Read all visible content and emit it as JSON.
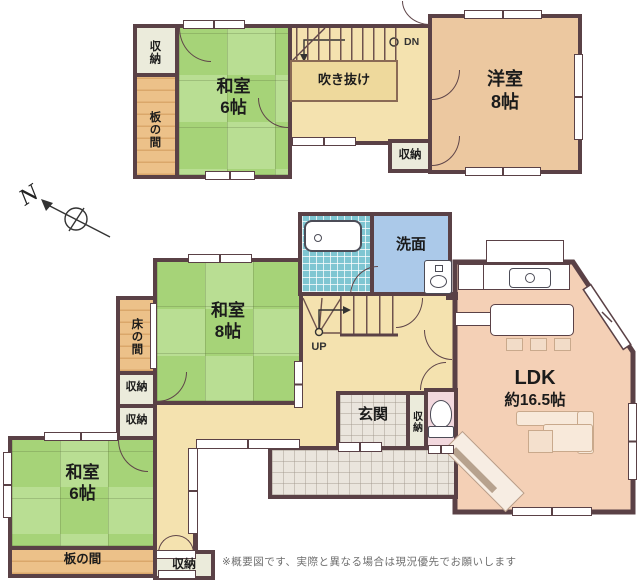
{
  "meta": {
    "footer_note": "※概要図です、実際と異なる場合は現況優先でお願いします"
  },
  "compass": {
    "label": "N"
  },
  "floor2": {
    "closet_top": {
      "label": "収納"
    },
    "itanoma": {
      "label": "板の間"
    },
    "washitsu6": {
      "name": "和室",
      "size": "6帖"
    },
    "stairs": {
      "dn": "DN"
    },
    "void": {
      "label": "吹き抜け"
    },
    "closet_mid": {
      "label": "収納"
    },
    "youshitsu8": {
      "name": "洋室",
      "size": "8帖"
    }
  },
  "floor1": {
    "washitsu8": {
      "name": "和室",
      "size": "8帖"
    },
    "tokonoma": {
      "label": "床の間"
    },
    "closet_a": {
      "label": "収納"
    },
    "closet_b": {
      "label": "収納"
    },
    "senmen": {
      "label": "洗面"
    },
    "stairs": {
      "up": "UP"
    },
    "genkan": {
      "label": "玄関"
    },
    "shoe_closet": {
      "label": "収納"
    },
    "washitsu6": {
      "name": "和室",
      "size": "6帖"
    },
    "itanoma": {
      "label": "板の間"
    },
    "closet_c": {
      "label": "収納"
    },
    "ldk": {
      "name": "LDK",
      "size": "約16.5帖"
    }
  },
  "colors": {
    "wall": "#5a4146",
    "tatami": "#aed57f",
    "wood": "#ecc189",
    "hall_cream": "#f4e2af",
    "void_fill": "#eed99c",
    "western_room": "#ecc8a0",
    "ldk": "#f4d0b6",
    "bath_tile": "#7fc6d2",
    "washroom_blue": "#abc9e9",
    "toilet_pink": "#f2d8de",
    "closet": "#ebebdb",
    "tile_gray": "#eae5dd"
  }
}
